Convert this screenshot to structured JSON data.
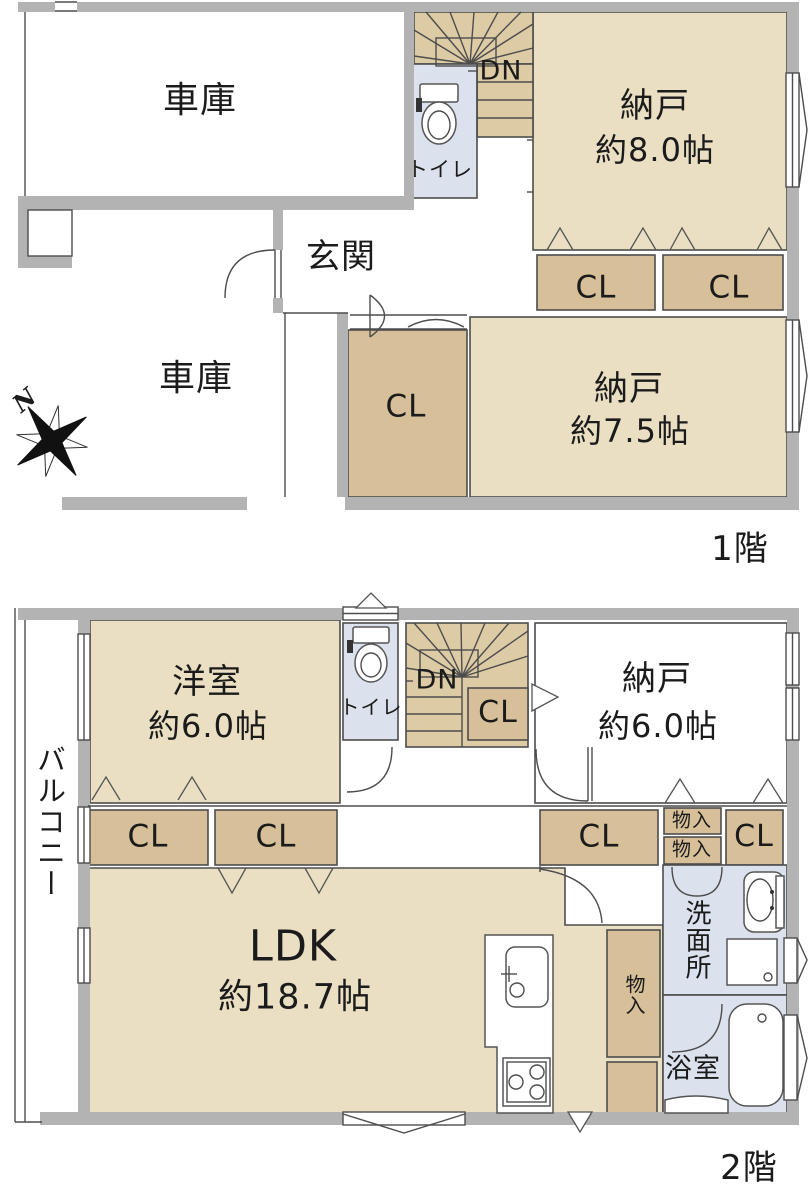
{
  "palette": {
    "wall": "#b3b3b3",
    "room": "#eadfc3",
    "closet": "#d6bf99",
    "stairs": "#ddcba6",
    "wet": "#dbe1ed",
    "line": "#4d4d4d",
    "ink": "#1b1b1b"
  },
  "compass": {
    "north": "N"
  },
  "floor1": {
    "label": "1階",
    "garage_top": "車庫",
    "garage_bottom": "車庫",
    "entrance": "玄関",
    "toilet": "トイレ",
    "stairs": "DN",
    "storage_a": {
      "name": "納戸",
      "size": "約8.0帖"
    },
    "storage_b": {
      "name": "納戸",
      "size": "約7.5帖"
    },
    "closet_a": "CL",
    "closet_b": "CL",
    "closet_c": "CL"
  },
  "floor2": {
    "label": "2階",
    "balcony": "バルコニー",
    "western_room": {
      "name": "洋室",
      "size": "約6.0帖"
    },
    "toilet": "トイレ",
    "stairs": "DN",
    "stair_closet": "CL",
    "storage": {
      "name": "納戸",
      "size": "約6.0帖"
    },
    "closet_a": "CL",
    "closet_b": "CL",
    "closet_c": "CL",
    "closet_d": "CL",
    "storage_small_a": "物入",
    "storage_small_b": "物入",
    "storage_small_c": "物入",
    "ldk": {
      "name": "LDK",
      "size": "約18.7帖"
    },
    "washroom": "洗面所",
    "bathroom": "浴室"
  }
}
